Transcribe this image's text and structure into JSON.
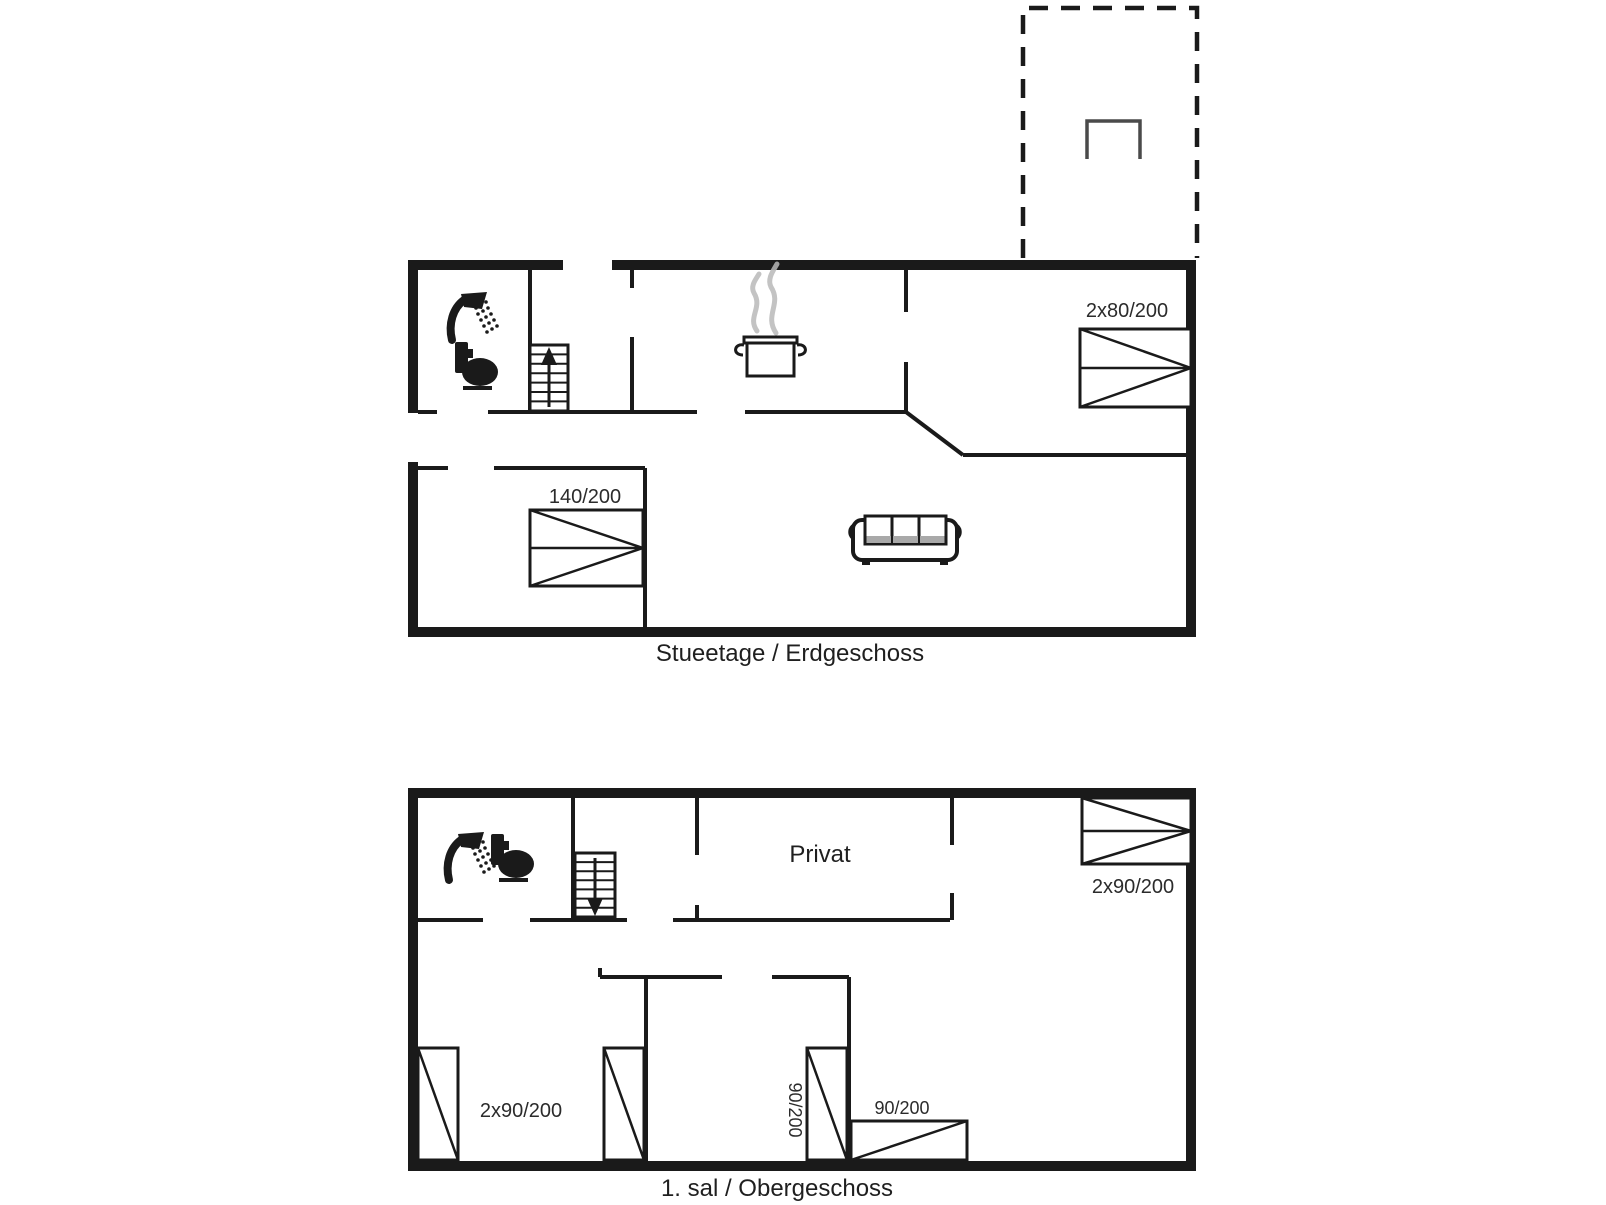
{
  "plan": {
    "terrace": {
      "table_icon": "table-icon"
    },
    "ground_floor": {
      "caption": "Stueetage / Erdgeschoss",
      "beds": {
        "double_right": "2x80/200",
        "double_left": "140/200"
      }
    },
    "first_floor": {
      "caption": "1. sal / Obergeschoss",
      "room": "Privat",
      "beds": {
        "double_top_right": "2x90/200",
        "twin_left_room": "2x90/200",
        "single_middle_vertical": "90/200",
        "single_bottom_horizontal": "90/200"
      }
    }
  },
  "colors": {
    "wall": "#1a1a1a",
    "text": "#1f1f1f",
    "steam": "#b8b8b8",
    "terrace_table": "#4a4a4a",
    "background": "#ffffff"
  }
}
